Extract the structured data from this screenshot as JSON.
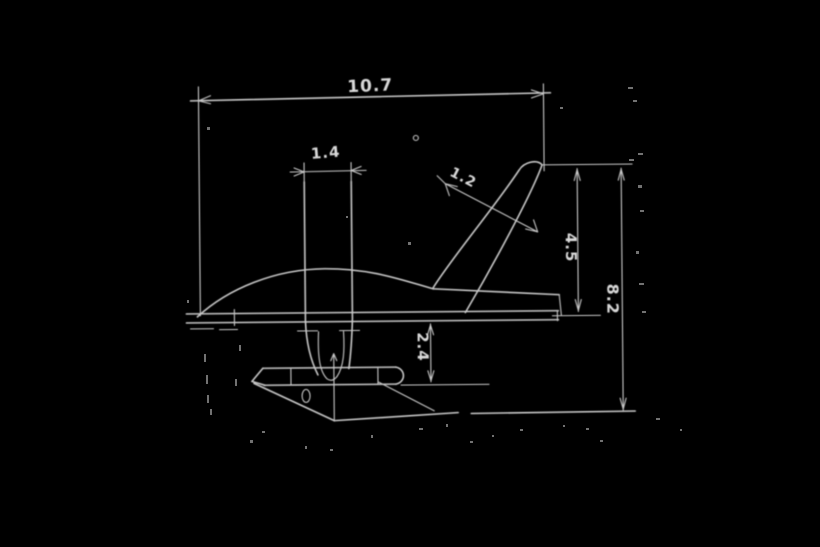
{
  "drawing": {
    "description": "scanned-technical-sketch-outboard-lower-unit-side-view",
    "background_color": "#000000",
    "line_color": "#c9c9c9",
    "text_color": "#d9d9d9",
    "dimensions": {
      "overall_length": "10.7",
      "strut_width": "1.4",
      "fin_thickness": "1.2",
      "fin_height": "4.5",
      "overall_height": "8.2",
      "gearcase_depth": "2.4"
    }
  }
}
